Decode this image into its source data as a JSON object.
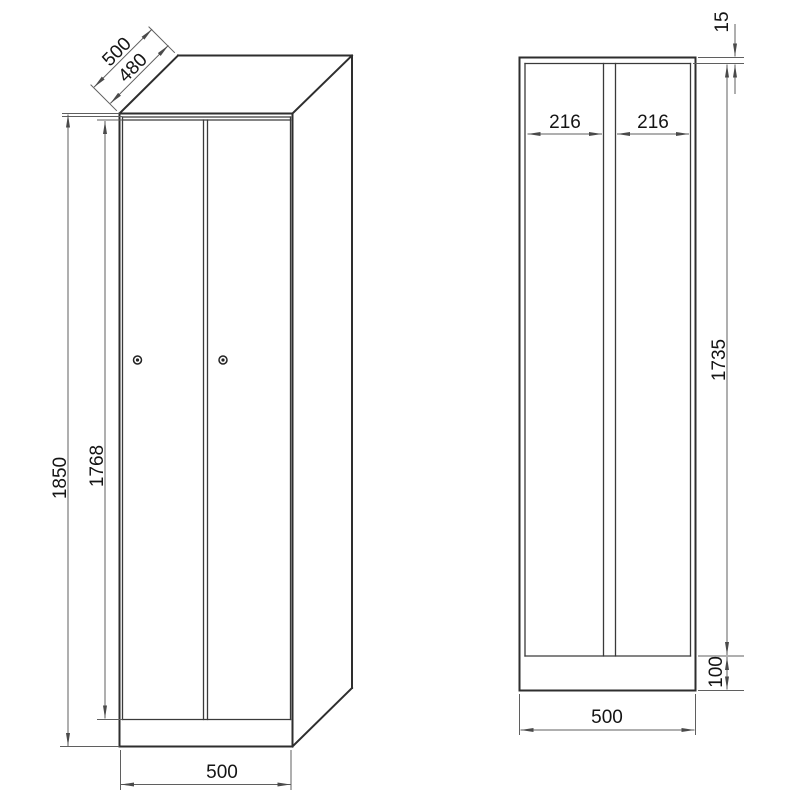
{
  "drawing": {
    "kind": "technical-dimension-drawing",
    "subject": "two-door locker cabinet, front view and cross-section view",
    "colors": {
      "background": "#ffffff",
      "outline": "#2e2e2e",
      "dimension_lines": "#5f5f5f",
      "dimension_text": "#141414"
    },
    "front_view": {
      "dims": {
        "depth": "500",
        "depth_inner": "480",
        "height": "1850",
        "door_height": "1768",
        "width": "500"
      }
    },
    "section_view": {
      "dims": {
        "left_compartment": "216",
        "right_compartment": "216",
        "top_offset": "15",
        "interior_height": "1735",
        "plinth_height": "100",
        "width": "500"
      }
    }
  }
}
